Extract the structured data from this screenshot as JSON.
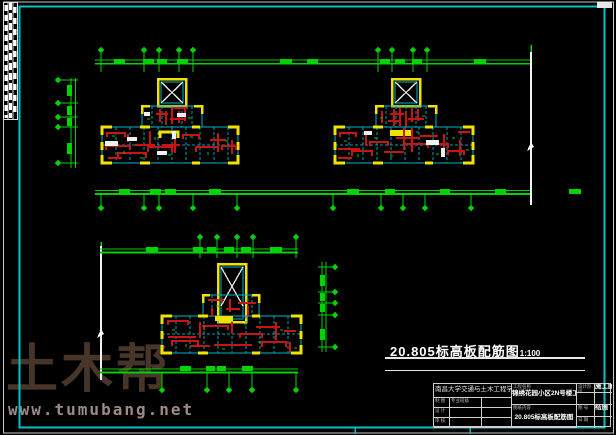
{
  "app": {
    "type": "CAD drawing viewport",
    "background": "#000000"
  },
  "colors": {
    "frame_cyan": "#00c4c4",
    "dimension_green": "#00d400",
    "wall_yellow": "#f2e200",
    "rebar_red": "#c81414",
    "slab_cyan": "#00b4c8",
    "line_white": "#ffffff",
    "watermark_brown": "#463528",
    "url_gray": "#9a8b87"
  },
  "drawing_title": {
    "text": "20.805标高板配筋图",
    "scale": "1:100"
  },
  "watermark": {
    "text": "土木帮",
    "url": "www.tumubang.net"
  },
  "title_block": {
    "school": "南昌大学交通与土木工程学院",
    "project_label": "工程名称",
    "project_name": "锦绣花园小区2N号楼工程设计",
    "stage_label": "设计阶段",
    "stage_value": "施工图",
    "content_label": "图纸内容",
    "content_value": "20.805标高板配筋图",
    "sheet_no_label": "图 号",
    "sheet_no_value": "结施",
    "date_label": "日 期",
    "date_value": "",
    "class_label": "专业班级",
    "rows": [
      {
        "label": "制 图"
      },
      {
        "label": "设 计"
      },
      {
        "label": "审 核"
      }
    ]
  },
  "plans": [
    {
      "id": "floor-plan-top-left",
      "description": "slab reinforcement plan, left unit"
    },
    {
      "id": "floor-plan-top-right",
      "description": "slab reinforcement plan, right unit"
    },
    {
      "id": "floor-plan-bottom",
      "description": "slab reinforcement plan, lower unit"
    }
  ]
}
